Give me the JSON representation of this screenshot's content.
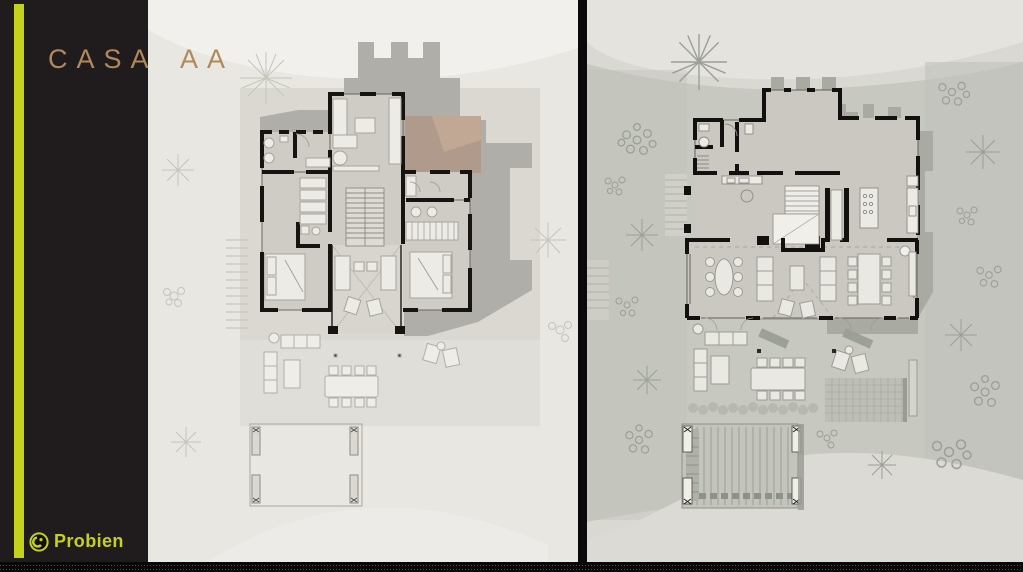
{
  "title": "CASA AA",
  "brand": {
    "name": "Probien"
  },
  "theme": {
    "accent_green": "#c5d21d",
    "title_gold": "#b0895a",
    "sidebar_black": "#201c1d",
    "divider_black": "#0b0909",
    "left_plan_background": "#e9e7e2",
    "right_plan_background": "#dad8d3",
    "wall_black": "#161310",
    "roof_shadow_gray": "#b0aea8",
    "roof_terrace_tan": "#b09a8c"
  }
}
